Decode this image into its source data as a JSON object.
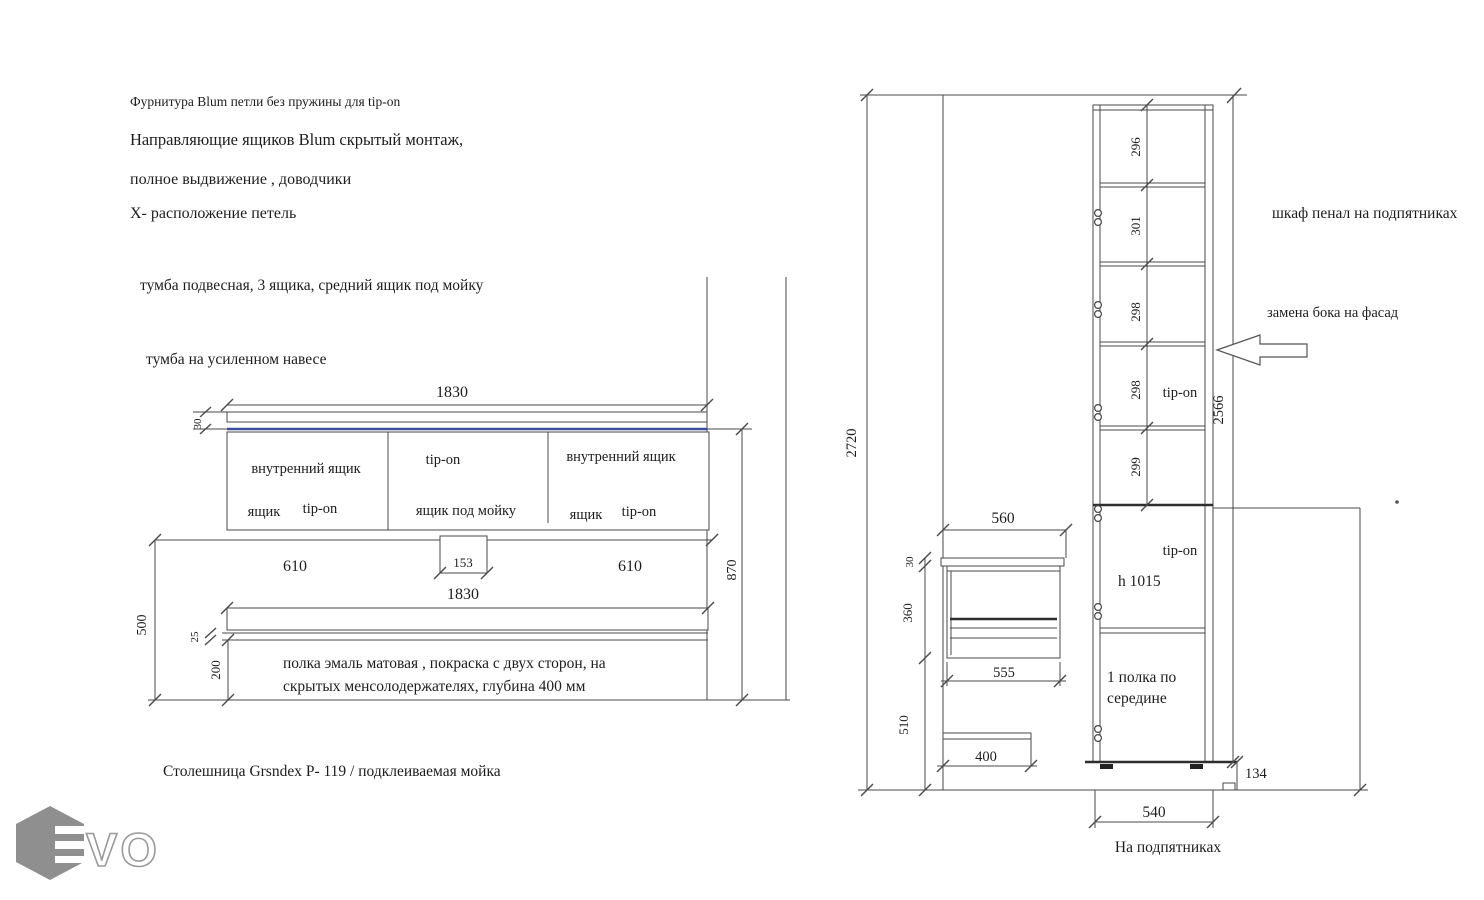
{
  "notes": {
    "line1": "Фурнитура Blum петли без пружины для tip-on",
    "line2": "Направляющие ящиков Blum скрытый монтаж,",
    "line3": "полное выдвижение , доводчики",
    "line4": "Х- расположение петель"
  },
  "left": {
    "title": "тумба подвесная, 3 ящика, средний ящик  под мойку",
    "subtitle": "тумба на усиленном навесе",
    "dims": {
      "width_top": "1830",
      "countertop_thickness": "30",
      "left_section": "610",
      "sink_drop": "153",
      "right_section": "610",
      "width_bottom": "1830",
      "height_right": "870",
      "shelf_drop": "500",
      "shelf_thickness": "25",
      "shelf_gap": "200"
    },
    "compartments": {
      "left_top": "внутренний ящик",
      "left_b1": "ящик",
      "left_b2": "tip-on",
      "mid_top": "tip-on",
      "mid_bottom": "ящик под мойку",
      "right_top": "внутренний ящик",
      "right_b1": "ящик",
      "right_b2": "tip-on"
    },
    "shelf_note1": "полка эмаль матовая , покраска с двух сторон, на",
    "shelf_note2": "скрытых   менсолодержателях, глубина  400 мм",
    "countertop_note": "Столешница Grsndex P- 119 / подклеиваемая мойка"
  },
  "right": {
    "title": "шкаф пенал на подпятниках",
    "facade_note": "замена бока на фасад",
    "sections": {
      "s1": "296",
      "s2": "301",
      "s3": "298",
      "s4": "298",
      "s5": "299"
    },
    "dims": {
      "total_height": "2720",
      "cabinet_height": "2566",
      "upper_width": "560",
      "top_thickness": "30",
      "upper_height": "360",
      "lower_width": "555",
      "lower_gap": "510",
      "shelf_width": "400",
      "base_height": "134",
      "base_width": "540"
    },
    "tip_on_upper": "tip-on",
    "tip_on_lower": "tip-on",
    "door_height": "h 1015",
    "shelf_note1": "1 полка по",
    "shelf_note2": "середине",
    "base_note": "На подпятниках"
  },
  "logo": {
    "letters": "VO"
  },
  "colors": {
    "accent_blue": "#3f4e9c",
    "line": "#4a4a4a",
    "logo_gray": "#8f8f8f"
  }
}
